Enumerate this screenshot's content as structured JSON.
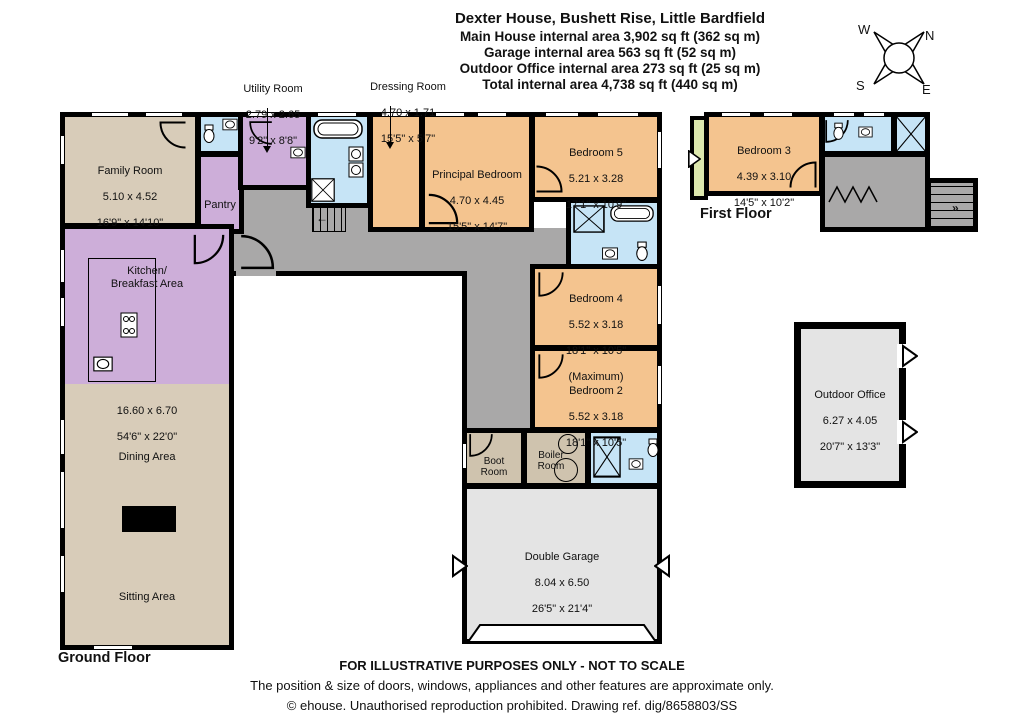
{
  "header": {
    "title": "Dexter House, Bushett Rise, Little Bardfield",
    "line1": "Main House internal area 3,902 sq ft (362 sq m)",
    "line2": "Garage internal area 563 sq ft (52 sq m)",
    "line3": "Outdoor Office internal area 273 sq ft (25 sq m)",
    "line4": "Total internal area 4,738 sq ft (440 sq m)"
  },
  "compass": {
    "north": "N",
    "south": "S",
    "east": "E",
    "west": "W"
  },
  "floor_labels": {
    "ground": "Ground Floor",
    "first": "First Floor"
  },
  "rooms": {
    "family": {
      "name": "Family Room",
      "metric": "5.10 x 4.52",
      "imperial": "16'9\" x 14'10\""
    },
    "pantry": {
      "name": "Pantry"
    },
    "utility": {
      "name": "Utility Room",
      "metric": "2.79 x 2.65",
      "imperial": "9'2\" x 8'8\""
    },
    "dressing": {
      "name": "Dressing Room",
      "metric": "4.70 x 1.71",
      "imperial": "15'5\" x 5'7\""
    },
    "principal": {
      "name": "Principal Bedroom",
      "metric": "4.70 x 4.45",
      "imperial": "15'5\" x 14'7\""
    },
    "bedroom5": {
      "name": "Bedroom 5",
      "metric": "5.21 x 3.28",
      "imperial": "17'1\" x 10'9\""
    },
    "bedroom4": {
      "name": "Bedroom 4",
      "metric": "5.52 x 3.18",
      "imperial": "18'1\" x 10'5\"",
      "note": "(Maximum)"
    },
    "bedroom2": {
      "name": "Bedroom 2",
      "metric": "5.52 x 3.18",
      "imperial": "18'1\" x 10'5\""
    },
    "bedroom3": {
      "name": "Bedroom 3",
      "metric": "4.39 x 3.10",
      "imperial": "14'5\" x 10'2\""
    },
    "kitchen": {
      "name": "Kitchen/\nBreakfast Area"
    },
    "open_plan": {
      "metric": "16.60 x 6.70",
      "imperial": "54'6\" x 22'0\""
    },
    "dining": {
      "name": "Dining Area"
    },
    "sitting": {
      "name": "Sitting Area"
    },
    "boot": {
      "name": "Boot\nRoom"
    },
    "boiler": {
      "name": "Boiler\nRoom"
    },
    "garage": {
      "name": "Double Garage",
      "metric": "8.04 x 6.50",
      "imperial": "26'5\" x 21'4\""
    },
    "office": {
      "name": "Outdoor Office",
      "metric": "6.27 x 4.05",
      "imperial": "20'7\" x 13'3\""
    }
  },
  "footer": {
    "disclaimer": "FOR ILLUSTRATIVE PURPOSES ONLY - NOT TO SCALE",
    "approx": "The position & size of doors, windows, appliances and other features are approximate only.",
    "copyright": "© ehouse. Unauthorised reproduction prohibited. Drawing ref. dig/8658803/SS"
  },
  "colors": {
    "wall": "#000000",
    "bedroom_fill": "#f4c48f",
    "bathroom_fill": "#c6e4f6",
    "kitchen_fill": "#cdaed9",
    "living_fill": "#d8ccb9",
    "boot_fill": "#cfc3ae",
    "hall_fill": "#a9a8a8",
    "garage_fill": "#e4e4e4",
    "balcony_fill": "#dde8ae"
  }
}
